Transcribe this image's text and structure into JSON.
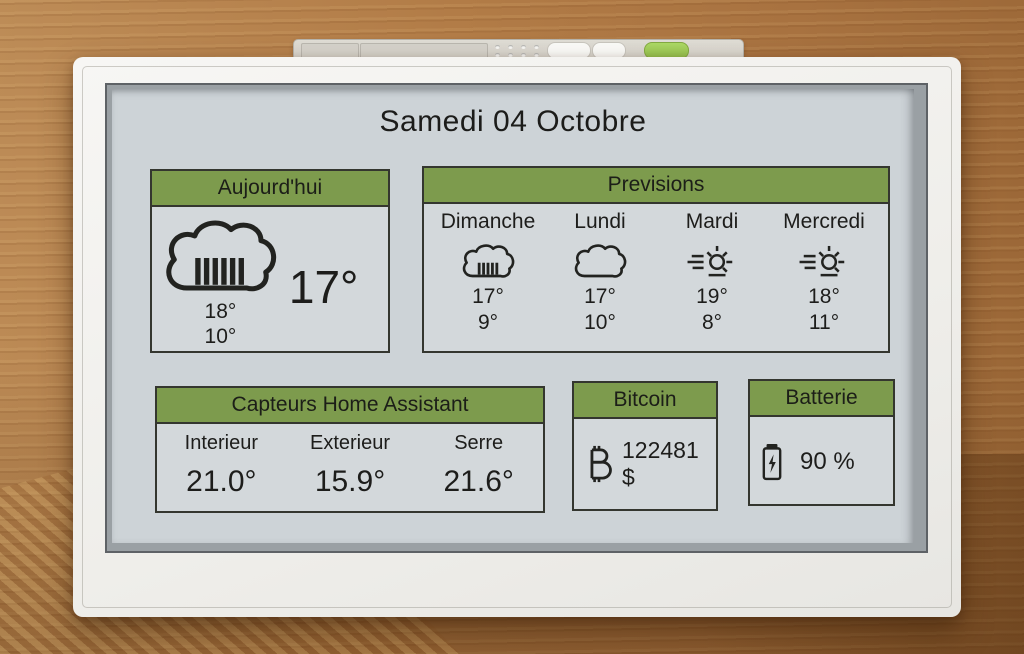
{
  "screen": {
    "title": "Samedi 04 Octobre",
    "colors": {
      "header_green": "#7d9b4d",
      "screen_bg": "#cdd3d7",
      "ink": "#222320",
      "power_button_green": "#93bf4b"
    }
  },
  "today": {
    "header": "Aujourd'hui",
    "icon": "rain-cloud",
    "temp_now": "17°",
    "temp_high": "18°",
    "temp_low": "10°"
  },
  "forecast": {
    "header": "Previsions",
    "days": [
      {
        "name": "Dimanche",
        "icon": "rain-cloud",
        "high": "17°",
        "low": "9°"
      },
      {
        "name": "Lundi",
        "icon": "cloud",
        "high": "17°",
        "low": "10°"
      },
      {
        "name": "Mardi",
        "icon": "hazy-sun",
        "high": "19°",
        "low": "8°"
      },
      {
        "name": "Mercredi",
        "icon": "hazy-sun",
        "high": "18°",
        "low": "11°"
      }
    ]
  },
  "sensors": {
    "header": "Capteurs Home Assistant",
    "items": [
      {
        "label": "Interieur",
        "value": "21.0°"
      },
      {
        "label": "Exterieur",
        "value": "15.9°"
      },
      {
        "label": "Serre",
        "value": "21.6°"
      }
    ]
  },
  "bitcoin": {
    "header": "Bitcoin",
    "icon": "bitcoin",
    "value": "122481 $"
  },
  "battery": {
    "header": "Batterie",
    "icon": "battery-charging",
    "value": "90 %"
  }
}
